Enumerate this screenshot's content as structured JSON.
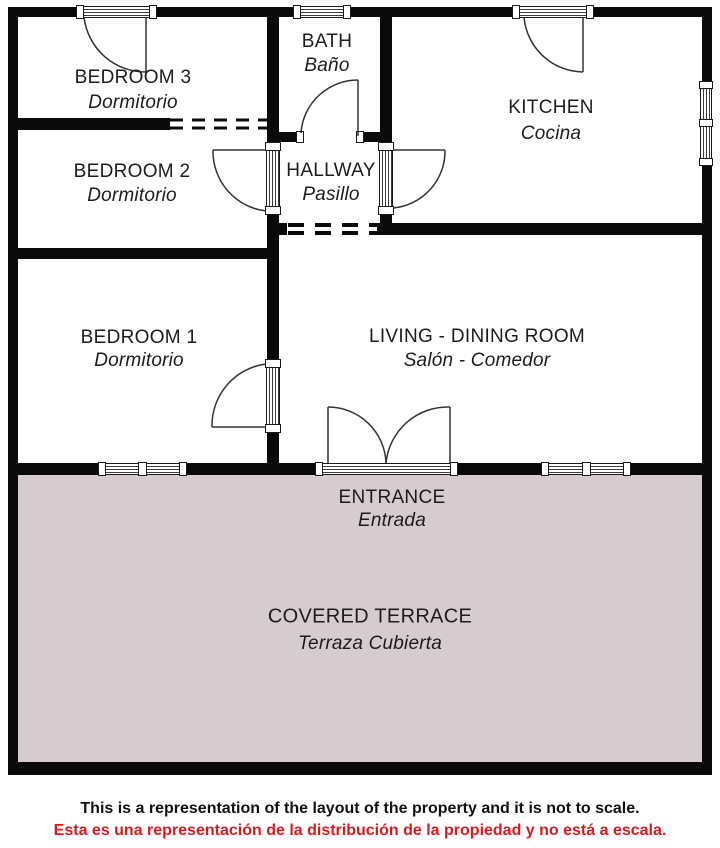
{
  "colors": {
    "wall": "#0a0a0a",
    "terrace_fill": "#d6cbce",
    "label_text": "#1c1c1c",
    "disclaimer_text": "#111111",
    "disclaimer_red": "#d81920"
  },
  "rooms": [
    {
      "name": "BEDROOM 3",
      "name_es": "Dormitorio"
    },
    {
      "name": "BATH",
      "name_es": "Baño"
    },
    {
      "name": "KITCHEN",
      "name_es": "Cocina"
    },
    {
      "name": "BEDROOM 2",
      "name_es": "Dormitorio"
    },
    {
      "name": "HALLWAY",
      "name_es": "Pasillo"
    },
    {
      "name": "BEDROOM 1",
      "name_es": "Dormitorio"
    },
    {
      "name": "LIVING - DINING ROOM",
      "name_es": "Salón - Comedor"
    },
    {
      "name": "ENTRANCE",
      "name_es": "Entrada"
    },
    {
      "name": "COVERED TERRACE",
      "name_es": "Terraza Cubierta"
    }
  ],
  "disclaimer": {
    "en": "This is a representation of the layout of the property and it is not to scale.",
    "es": "Esta es una representación de la distribución de la propiedad y no está a escala."
  }
}
